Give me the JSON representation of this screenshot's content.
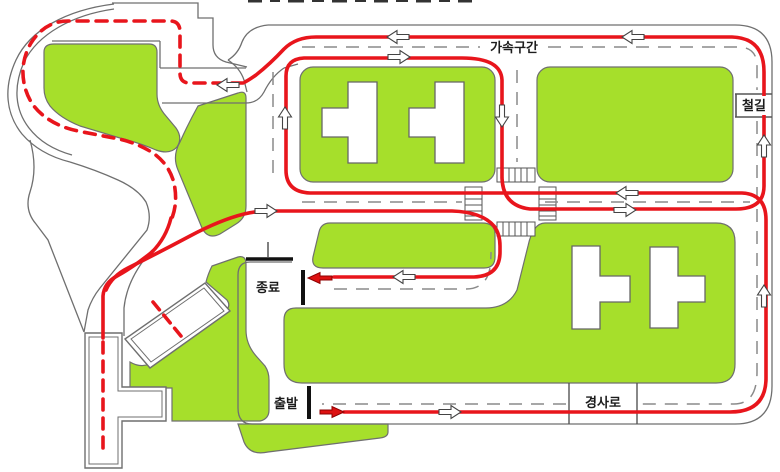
{
  "map": {
    "type": "driving-test-course-map",
    "labels": {
      "acceleration_zone": "가속구간",
      "railroad_crossing": "철길",
      "finish": "종료",
      "start": "출발",
      "ramp": "경사로"
    },
    "colors": {
      "grass": "#a6df2b",
      "route_red": "#e8151c",
      "road_edge": "#6f6f6f",
      "lane_dash": "#8a8a8a",
      "marker_black": "#111111",
      "arrow_fill": "#ffffff",
      "building_fill": "#ffffff"
    },
    "route": {
      "main_style": "solid red line",
      "course_style": "dashed red line (S-curve, crank, T-course, parking box)",
      "start_label": "출발",
      "finish_label": "종료"
    },
    "direction_arrows": [
      {
        "id": "W1",
        "road": "crank-entrance",
        "direction": "left",
        "color": "white"
      },
      {
        "id": "W2",
        "road": "middle-road-eastbound",
        "direction": "right",
        "color": "white"
      },
      {
        "id": "W3",
        "road": "finish-road",
        "direction": "left",
        "color": "white"
      },
      {
        "id": "W4",
        "road": "bottom-road",
        "direction": "right",
        "color": "white"
      },
      {
        "id": "W5",
        "road": "right-road-lower",
        "direction": "up",
        "color": "white"
      },
      {
        "id": "W6",
        "road": "middle-road-eastbound",
        "direction": "right",
        "color": "white"
      },
      {
        "id": "W7",
        "road": "middle-road-westbound",
        "direction": "left",
        "color": "white"
      },
      {
        "id": "W8",
        "road": "left-vertical-road",
        "direction": "up",
        "color": "white"
      },
      {
        "id": "W9",
        "road": "top-road-eastbound",
        "direction": "right",
        "color": "white"
      },
      {
        "id": "W10",
        "road": "central-vertical-road",
        "direction": "down",
        "color": "white"
      },
      {
        "id": "W11",
        "road": "right-road-upper",
        "direction": "up",
        "color": "white"
      },
      {
        "id": "W12",
        "road": "top-road-westbound",
        "direction": "left",
        "color": "white"
      },
      {
        "id": "W13",
        "road": "top-road-westbound",
        "direction": "left",
        "color": "white"
      },
      {
        "id": "R1",
        "road": "finish-road",
        "direction": "left",
        "color": "red"
      },
      {
        "id": "R2",
        "road": "start-road",
        "direction": "right",
        "color": "red"
      }
    ]
  }
}
